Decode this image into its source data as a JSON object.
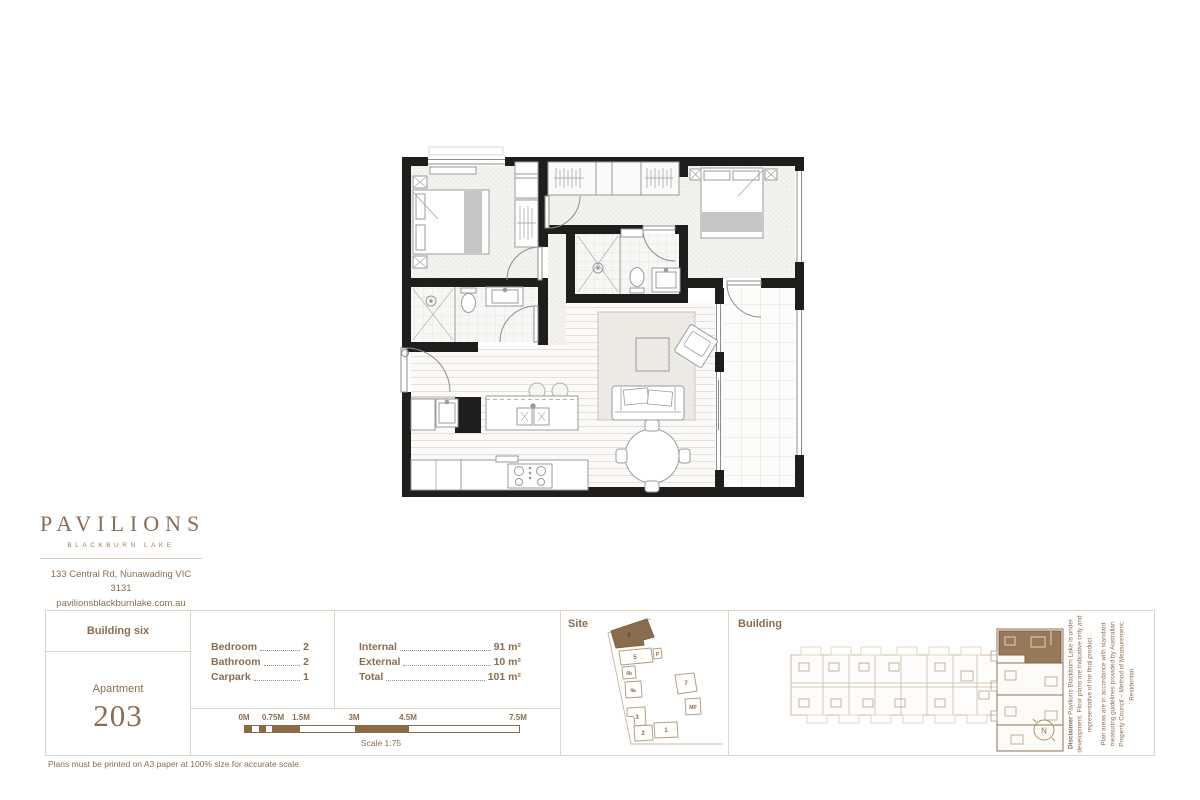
{
  "brand": {
    "name": "PAVILIONS",
    "tagline": "BLACKBURN LAKE",
    "address": "133 Central Rd, Nunawading VIC 3131",
    "website": "pavilionsblackburnlake.com.au",
    "phone": "1800 728 454"
  },
  "unit": {
    "building": "Building six",
    "label": "Apartment",
    "number": "203"
  },
  "features": {
    "rows": [
      {
        "label": "Bedroom",
        "value": "2"
      },
      {
        "label": "Bathroom",
        "value": "2"
      },
      {
        "label": "Carpark",
        "value": "1"
      }
    ]
  },
  "areas": {
    "rows": [
      {
        "label": "Internal",
        "value": "91 m²"
      },
      {
        "label": "External",
        "value": "10 m²"
      },
      {
        "label": "Total",
        "value": "101 m²"
      }
    ]
  },
  "scale": {
    "ticks": [
      "0M",
      "0.75M",
      "1.5M",
      "3M",
      "4.5M",
      "7.5M"
    ],
    "caption": "Scale 1:75"
  },
  "site": {
    "title": "Site",
    "highlighted_building": "6",
    "buildings": [
      {
        "label": "6"
      },
      {
        "label": "5"
      },
      {
        "label": "P"
      },
      {
        "label": "4b"
      },
      {
        "label": "4a"
      },
      {
        "label": "3"
      },
      {
        "label": "2"
      },
      {
        "label": "1"
      },
      {
        "label": "7"
      },
      {
        "label": "MP"
      }
    ]
  },
  "building_panel": {
    "title": "Building",
    "compass": "N"
  },
  "disclaimer": {
    "heading": "Disclaimer",
    "line1": "Pavilions Blackburn Lake is under development. Floor plans are indicative only and representative of the final product.",
    "line2": "Plan areas are in accordance with standard measuring guidelines provided by Australian Property Council – Method of Measurement: Residential."
  },
  "footnote": "Plans must be printed on A3 paper at 100% size for accurate scale.",
  "colors": {
    "accent_brown": "#8B6E52",
    "highlight_fill": "#8A6D4E",
    "wall_black": "#1F1E1C",
    "panel_border": "#DFD3C3"
  }
}
